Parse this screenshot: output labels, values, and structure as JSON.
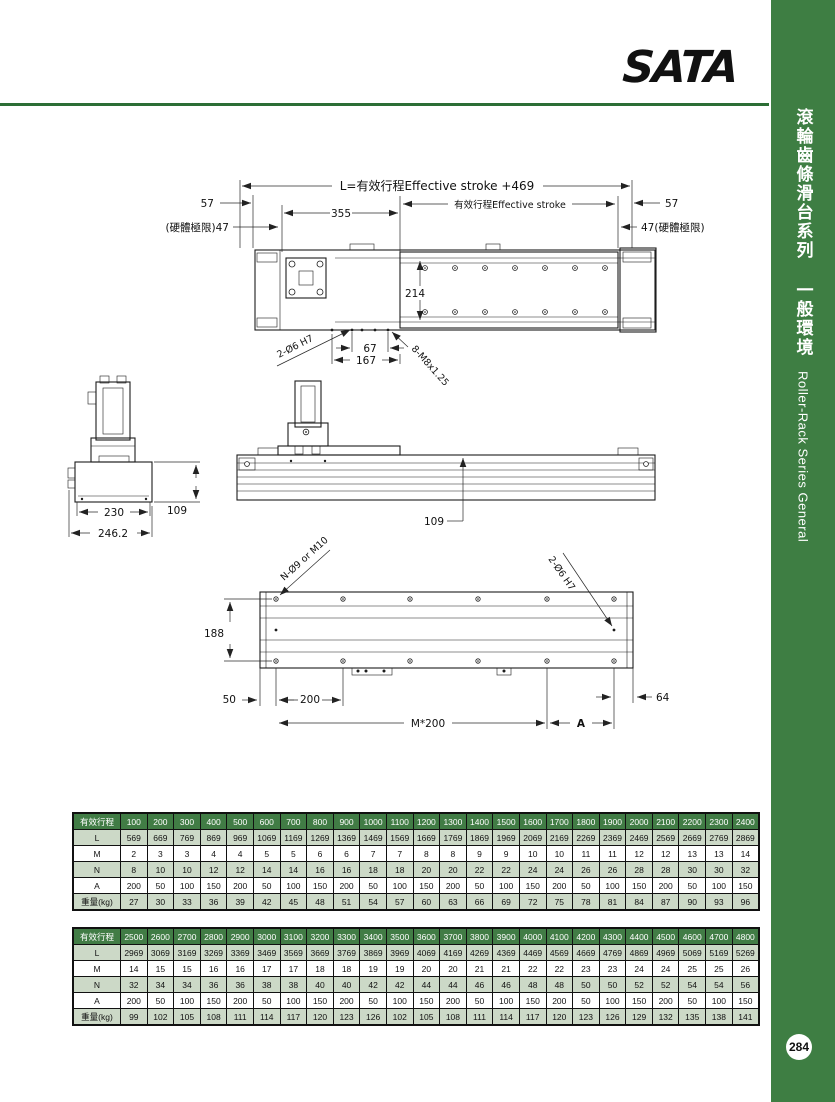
{
  "brand": {
    "logo_text": "SATA",
    "logo_color": "#1c69ae"
  },
  "sidebar": {
    "title_zh": "滾輪齒條滑台系列 一般環境",
    "title_en": "Roller-Rack Series General",
    "bg_color": "#3e7e43",
    "page_number": "284"
  },
  "drawings": {
    "plan": {
      "dim_overall": "L=有效行程Effective stroke +469",
      "dim_57_left": "57",
      "dim_355": "355",
      "dim_stroke": "有效行程Effective stroke",
      "dim_57_right": "57",
      "dim_47_left": "(硬體極限)47",
      "dim_47_right": "47(硬體極限)",
      "dim_214": "214",
      "dim_67": "67",
      "dim_167": "167",
      "label_pin_holes": "2-Ø6  H7",
      "label_threads": "8-M8x1.25"
    },
    "end_view": {
      "dim_230": "230",
      "dim_246": "246.2",
      "dim_109": "109"
    },
    "side_view": {
      "dim_109": "109"
    },
    "bottom_view": {
      "label_mount_holes": "N-Ø9 or M10",
      "label_pin_holes": "2-Ø6  H7",
      "dim_188": "188",
      "dim_50": "50",
      "dim_200": "200",
      "dim_m200": "M*200",
      "dim_a": "A",
      "dim_64": "64"
    }
  },
  "tables": [
    {
      "header_label": "有效行程",
      "strokes": [
        100,
        200,
        300,
        400,
        500,
        600,
        700,
        800,
        900,
        1000,
        1100,
        1200,
        1300,
        1400,
        1500,
        1600,
        1700,
        1800,
        1900,
        2000,
        2100,
        2200,
        2300,
        2400
      ],
      "rows": [
        {
          "label": "L",
          "values": [
            569,
            669,
            769,
            869,
            969,
            1069,
            1169,
            1269,
            1369,
            1469,
            1569,
            1669,
            1769,
            1869,
            1969,
            2069,
            2169,
            2269,
            2369,
            2469,
            2569,
            2669,
            2769,
            2869
          ]
        },
        {
          "label": "M",
          "values": [
            2,
            3,
            3,
            4,
            4,
            5,
            5,
            6,
            6,
            7,
            7,
            8,
            8,
            9,
            9,
            10,
            10,
            11,
            11,
            12,
            12,
            13,
            13,
            14
          ]
        },
        {
          "label": "N",
          "values": [
            8,
            10,
            10,
            12,
            12,
            14,
            14,
            16,
            16,
            18,
            18,
            20,
            20,
            22,
            22,
            24,
            24,
            26,
            26,
            28,
            28,
            30,
            30,
            32
          ]
        },
        {
          "label": "A",
          "values": [
            200,
            50,
            100,
            150,
            200,
            50,
            100,
            150,
            200,
            50,
            100,
            150,
            200,
            50,
            100,
            150,
            200,
            50,
            100,
            150,
            200,
            50,
            100,
            150
          ]
        },
        {
          "label": "重量(kg)",
          "values": [
            27,
            30,
            33,
            36,
            39,
            42,
            45,
            48,
            51,
            54,
            57,
            60,
            63,
            66,
            69,
            72,
            75,
            78,
            81,
            84,
            87,
            90,
            93,
            96
          ]
        }
      ]
    },
    {
      "header_label": "有效行程",
      "strokes": [
        2500,
        2600,
        2700,
        2800,
        2900,
        3000,
        3100,
        3200,
        3300,
        3400,
        3500,
        3600,
        3700,
        3800,
        3900,
        4000,
        4100,
        4200,
        4300,
        4400,
        4500,
        4600,
        4700,
        4800
      ],
      "rows": [
        {
          "label": "L",
          "values": [
            2969,
            3069,
            3169,
            3269,
            3369,
            3469,
            3569,
            3669,
            3769,
            3869,
            3969,
            4069,
            4169,
            4269,
            4369,
            4469,
            4569,
            4669,
            4769,
            4869,
            4969,
            5069,
            5169,
            5269
          ]
        },
        {
          "label": "M",
          "values": [
            14,
            15,
            15,
            16,
            16,
            17,
            17,
            18,
            18,
            19,
            19,
            20,
            20,
            21,
            21,
            22,
            22,
            23,
            23,
            24,
            24,
            25,
            25,
            26
          ]
        },
        {
          "label": "N",
          "values": [
            32,
            34,
            34,
            36,
            36,
            38,
            38,
            40,
            40,
            42,
            42,
            44,
            44,
            46,
            46,
            48,
            48,
            50,
            50,
            52,
            52,
            54,
            54,
            56
          ]
        },
        {
          "label": "A",
          "values": [
            200,
            50,
            100,
            150,
            200,
            50,
            100,
            150,
            200,
            50,
            100,
            150,
            200,
            50,
            100,
            150,
            200,
            50,
            100,
            150,
            200,
            50,
            100,
            150
          ]
        },
        {
          "label": "重量(kg)",
          "values": [
            99,
            102,
            105,
            108,
            111,
            114,
            117,
            120,
            123,
            126,
            102,
            105,
            108,
            111,
            114,
            117,
            120,
            123,
            126,
            129,
            132,
            135,
            138,
            141
          ]
        }
      ]
    }
  ]
}
